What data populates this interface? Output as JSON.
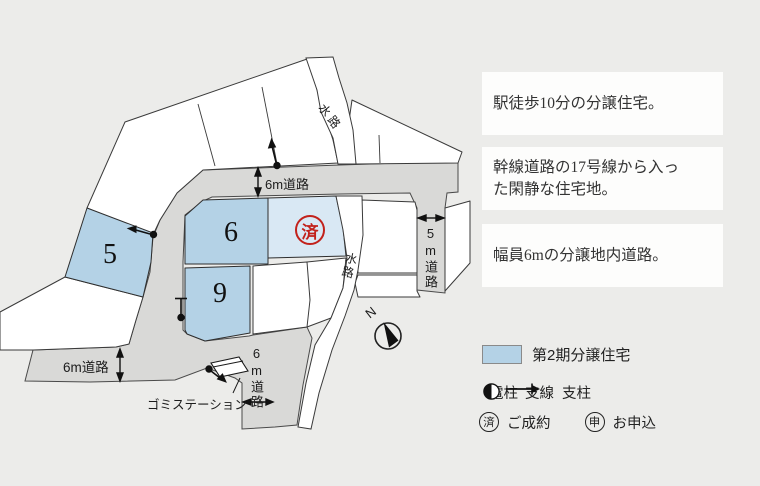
{
  "map": {
    "lots": {
      "lot5": "5",
      "lot6": "6",
      "lot9": "9"
    },
    "sold_stamp": "済",
    "labels": {
      "road_6m_top": "6m道路",
      "road_6m_left": "6m道路",
      "road_6m_bottom": "6m道路",
      "road_5m": "5m道路",
      "waterway_top": "水路",
      "waterway_mid": "水路",
      "garbage_station": "ゴミステーション",
      "north": "N"
    },
    "colors": {
      "background": "#ececea",
      "road": "#d9d9d7",
      "lot_white": "#ffffff",
      "lot_blue": "#b4d2e6",
      "lot_light_blue": "#d9e8f4",
      "stamp_red": "#c2211b"
    }
  },
  "panel": {
    "boxes": [
      {
        "text": "駅徒歩10分の分譲住宅。"
      },
      {
        "text": "幹線道路の17号線から入った閑静な住宅地。"
      },
      {
        "text": "幅員6mの分譲地内道路。"
      }
    ],
    "legend": {
      "swatch_label": "第2期分譲住宅",
      "pole_label": "電柱",
      "support_line_label": "支線",
      "post_label": "支柱",
      "sold_mark": "済",
      "sold_label": "ご成約",
      "applied_mark": "申",
      "applied_label": "お申込"
    }
  }
}
